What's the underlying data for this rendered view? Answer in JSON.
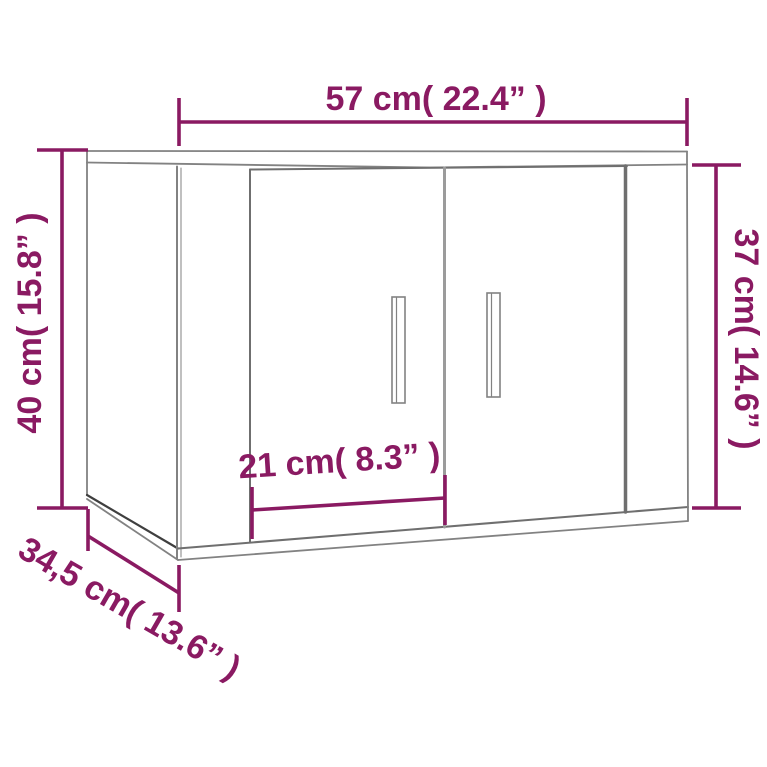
{
  "diagram": {
    "description": "Wall-mounted cabinet with two doors, technical dimension drawing",
    "colors": {
      "dimension": "#8a1a62",
      "outline": "#828282",
      "outline_medium": "#6f6f6f",
      "outline_dark": "#3f3f3f",
      "outline_light": "#9b9b9b",
      "background": "#ffffff"
    },
    "dimensions": {
      "width": {
        "label": "57 cm( 22.4” )",
        "cm": 57,
        "inches": 22.4
      },
      "height_left": {
        "label": "40 cm( 15.8” )",
        "cm": 40,
        "inches": 15.8
      },
      "height_right": {
        "label": "37 cm( 14.6” )",
        "cm": 37,
        "inches": 14.6
      },
      "door_width": {
        "label": "21 cm( 8.3” )",
        "cm": 21,
        "inches": 8.3
      },
      "depth": {
        "label": "34,5 cm( 13.6” )",
        "cm": 34.5,
        "inches": 13.6
      }
    }
  }
}
